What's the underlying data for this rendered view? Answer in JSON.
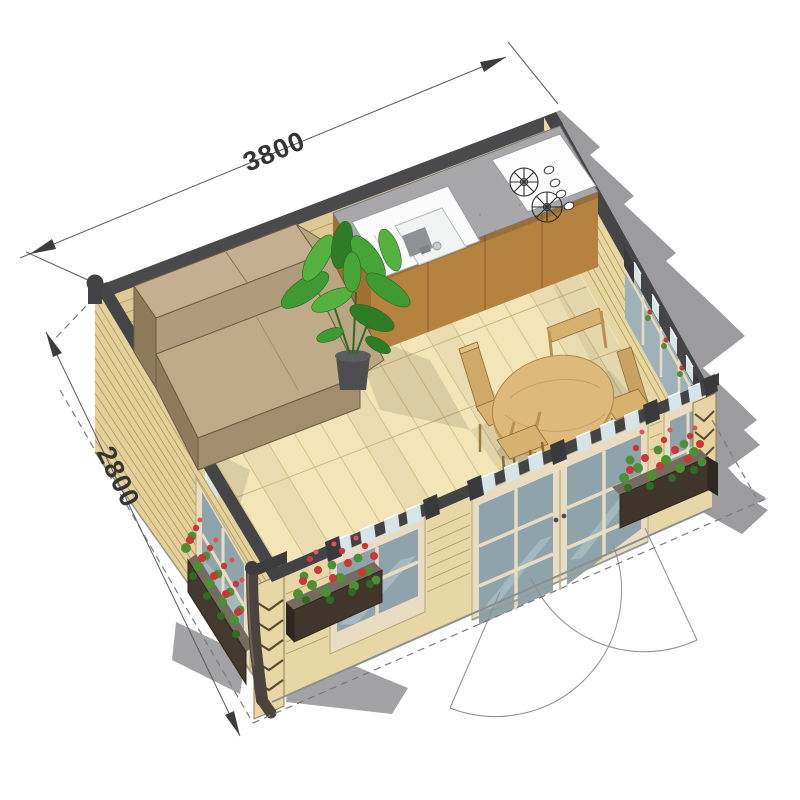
{
  "meta": {
    "description": "Isometric cutaway illustration of a small garden cabin interior",
    "view": "axonometric cutaway"
  },
  "dimensions": {
    "width_mm": "3800",
    "depth_mm": "2800"
  },
  "objects": {
    "sofa": "corner sofa",
    "plant": "potted banana plant",
    "sink": "kitchen sink",
    "cooktop": "two-burner cooktop",
    "counter": "kitchen counter with cabinets",
    "table": "round dining table",
    "chairs": "four wooden chairs",
    "flower_boxes": "window flower boxes with red flowers",
    "doors": "double glazed doors with outward swing",
    "windows": "glazed window walls",
    "downspout": "corner rain downspout"
  },
  "colors": {
    "floor": "#f3e5b7",
    "wall_wood": "#e3d09a",
    "cut_edge": "#454547",
    "counter": "#a8a8aa",
    "cabinet": "#b5823f",
    "sofa": "#bfab88",
    "table_wood": "#ddb97c",
    "glass": "#8fa3ad",
    "frame": "#e9dcc0",
    "shadow": "#9c9c9e",
    "flower_red": "#cc3636",
    "foliage_green": "#4d8f35",
    "dimension_text": "#343434"
  }
}
